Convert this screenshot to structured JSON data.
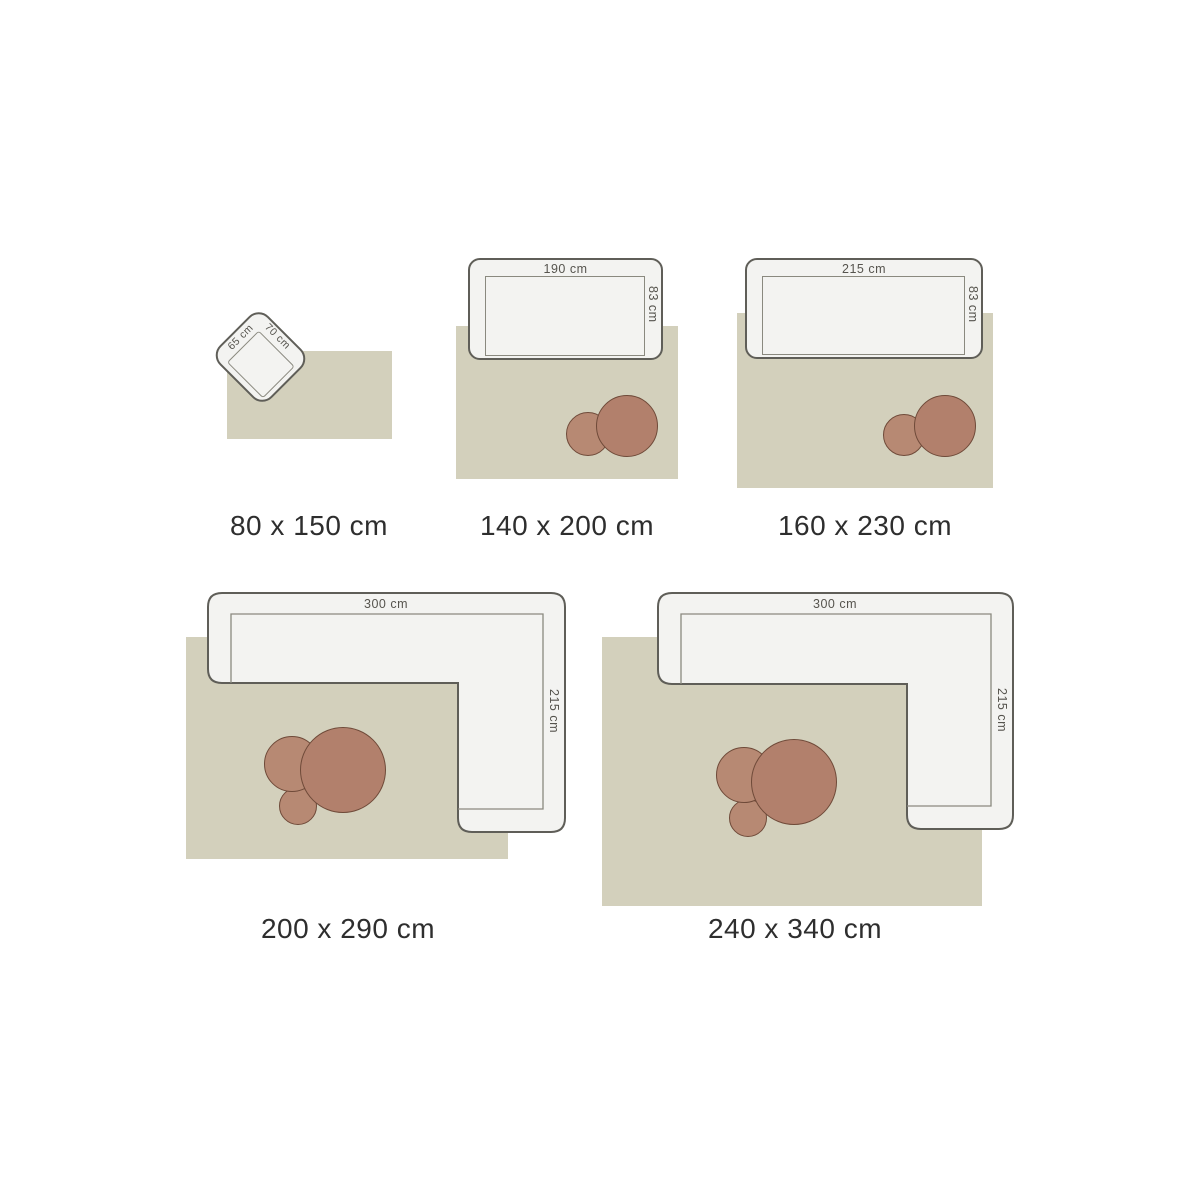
{
  "colors": {
    "rug": "#d3d0bc",
    "sofa_fill": "#f3f3f1",
    "sofa_border": "#5f5e58",
    "seat_line": "#8a897f",
    "table_fill": "#b2806c",
    "table_fill_light": "#b78973",
    "table_border": "#6f4a39",
    "caption": "#2e2e2e",
    "dim_text": "#56544e"
  },
  "items": [
    {
      "caption": "80 x 150 cm",
      "furniture": "armchair",
      "furniture_width_label": "65 cm",
      "furniture_depth_label": "70 cm"
    },
    {
      "caption": "140 x 200 cm",
      "furniture": "sofa",
      "furniture_width_label": "190 cm",
      "furniture_depth_label": "83 cm"
    },
    {
      "caption": "160 x 230 cm",
      "furniture": "sofa",
      "furniture_width_label": "215 cm",
      "furniture_depth_label": "83 cm"
    },
    {
      "caption": "200 x 290 cm",
      "furniture": "corner sofa",
      "furniture_width_label": "300 cm",
      "furniture_depth_label": "215 cm"
    },
    {
      "caption": "240 x 340 cm",
      "furniture": "corner sofa",
      "furniture_width_label": "300 cm",
      "furniture_depth_label": "215 cm"
    }
  ]
}
